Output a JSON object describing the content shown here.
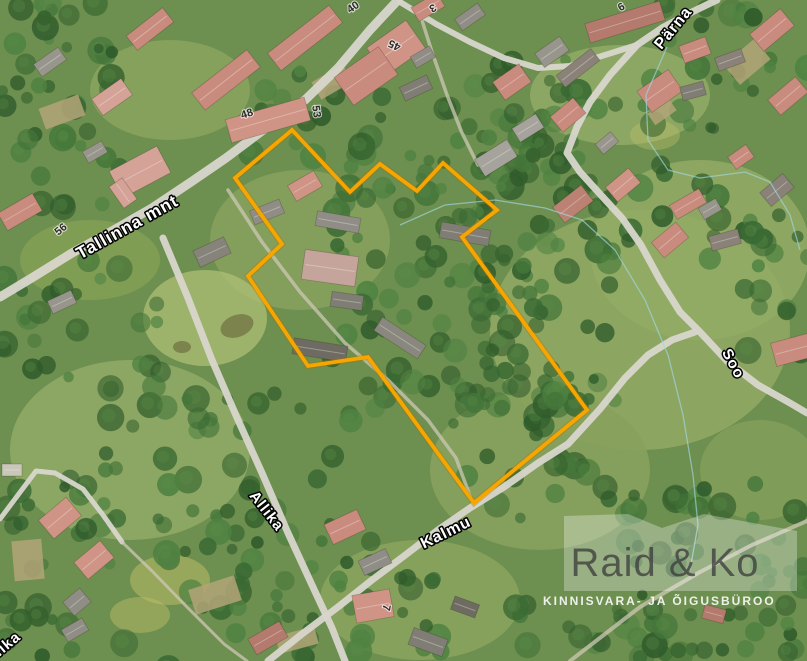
{
  "map": {
    "width": 807,
    "height": 661,
    "base_color": "#6d8f4f",
    "road_color": "#d8d6cc",
    "trail_color": "#cdc8b4",
    "boundary": {
      "color": "#F7A600",
      "glow_color": "#B36D00",
      "points": [
        [
          235,
          178
        ],
        [
          292,
          130
        ],
        [
          350,
          192
        ],
        [
          380,
          164
        ],
        [
          417,
          191
        ],
        [
          443,
          163
        ],
        [
          497,
          210
        ],
        [
          462,
          237
        ],
        [
          587,
          410
        ],
        [
          474,
          503
        ],
        [
          368,
          357
        ],
        [
          308,
          366
        ],
        [
          248,
          276
        ],
        [
          282,
          244
        ]
      ]
    },
    "cadastral_lines": {
      "color": "#9fd8e2",
      "lines": [
        [
          [
            400,
            225
          ],
          [
            445,
            205
          ],
          [
            495,
            200
          ],
          [
            545,
            208
          ],
          [
            582,
            220
          ],
          [
            615,
            250
          ],
          [
            645,
            300
          ],
          [
            668,
            355
          ],
          [
            683,
            415
          ],
          [
            693,
            475
          ],
          [
            698,
            525
          ],
          [
            690,
            570
          ]
        ],
        [
          [
            667,
            47
          ],
          [
            646,
            95
          ],
          [
            648,
            140
          ],
          [
            668,
            170
          ],
          [
            700,
            178
          ],
          [
            745,
            172
          ],
          [
            770,
            182
          ],
          [
            790,
            215
          ],
          [
            800,
            250
          ]
        ]
      ]
    },
    "roads": [
      {
        "name": "tallinna-mnt",
        "width": 9,
        "points": [
          [
            398,
            0
          ],
          [
            370,
            30
          ],
          [
            338,
            68
          ],
          [
            305,
            100
          ],
          [
            262,
            131
          ],
          [
            226,
            158
          ],
          [
            191,
            182
          ],
          [
            152,
            208
          ],
          [
            112,
            231
          ],
          [
            72,
            253
          ],
          [
            30,
            279
          ],
          [
            0,
            297
          ]
        ]
      },
      {
        "name": "parna-soo-road",
        "width": 7,
        "points": [
          [
            717,
            0
          ],
          [
            692,
            12
          ],
          [
            662,
            28
          ],
          [
            637,
            45
          ],
          [
            610,
            75
          ],
          [
            590,
            102
          ],
          [
            577,
            127
          ],
          [
            567,
            153
          ],
          [
            580,
            172
          ],
          [
            600,
            194
          ],
          [
            622,
            218
          ],
          [
            641,
            245
          ],
          [
            660,
            280
          ],
          [
            680,
            312
          ],
          [
            700,
            332
          ],
          [
            728,
            362
          ],
          [
            758,
            385
          ],
          [
            790,
            403
          ],
          [
            807,
            413
          ]
        ]
      },
      {
        "name": "north-link-road",
        "width": 6,
        "points": [
          [
            400,
            2
          ],
          [
            436,
            24
          ],
          [
            470,
            42
          ],
          [
            504,
            58
          ],
          [
            538,
            68
          ],
          [
            570,
            66
          ],
          [
            605,
            55
          ],
          [
            637,
            45
          ]
        ]
      },
      {
        "name": "allika-road",
        "width": 7,
        "points": [
          [
            163,
            238
          ],
          [
            188,
            298
          ],
          [
            212,
            360
          ],
          [
            238,
            420
          ],
          [
            262,
            473
          ],
          [
            288,
            533
          ],
          [
            312,
            585
          ],
          [
            332,
            628
          ],
          [
            345,
            661
          ]
        ]
      },
      {
        "name": "kalmu-road",
        "width": 7,
        "points": [
          [
            268,
            661
          ],
          [
            302,
            634
          ],
          [
            338,
            607
          ],
          [
            372,
            580
          ],
          [
            404,
            556
          ],
          [
            438,
            530
          ],
          [
            470,
            508
          ],
          [
            504,
            487
          ],
          [
            538,
            463
          ],
          [
            568,
            444
          ],
          [
            600,
            409
          ],
          [
            625,
            378
          ],
          [
            648,
            355
          ],
          [
            672,
            340
          ],
          [
            695,
            332
          ]
        ]
      },
      {
        "name": "west-lane",
        "width": 5,
        "points": [
          [
            0,
            519
          ],
          [
            36,
            471
          ],
          [
            55,
            473
          ],
          [
            83,
            489
          ],
          [
            103,
            515
          ],
          [
            122,
            542
          ]
        ]
      }
    ],
    "trails": [
      {
        "name": "west-trail",
        "width": 3,
        "points": [
          [
            122,
            542
          ],
          [
            152,
            571
          ],
          [
            186,
            606
          ],
          [
            224,
            644
          ],
          [
            247,
            661
          ]
        ]
      },
      {
        "name": "bottom-right-trail",
        "width": 4,
        "points": [
          [
            570,
            661
          ],
          [
            640,
            607
          ],
          [
            700,
            572
          ],
          [
            752,
            545
          ],
          [
            807,
            521
          ]
        ]
      },
      {
        "name": "north-driveway",
        "width": 3.5,
        "points": [
          [
            420,
            14
          ],
          [
            432,
            52
          ],
          [
            447,
            95
          ],
          [
            462,
            133
          ],
          [
            478,
            165
          ]
        ]
      },
      {
        "name": "farm-driveway",
        "width": 3.5,
        "points": [
          [
            228,
            190
          ],
          [
            262,
            242
          ],
          [
            300,
            292
          ],
          [
            345,
            343
          ],
          [
            388,
            380
          ],
          [
            428,
            420
          ],
          [
            456,
            458
          ],
          [
            470,
            496
          ]
        ]
      }
    ],
    "buildings": [
      [
        305,
        38,
        78,
        22,
        -38,
        "#c98b7d"
      ],
      [
        226,
        80,
        70,
        22,
        -38,
        "#c98b7d"
      ],
      [
        268,
        120,
        82,
        24,
        -16,
        "#cf9486"
      ],
      [
        150,
        29,
        46,
        18,
        -38,
        "#c98b7d"
      ],
      [
        112,
        97,
        36,
        20,
        -35,
        "#d4a296"
      ],
      [
        50,
        62,
        30,
        15,
        -35,
        "#98968c"
      ],
      [
        396,
        48,
        48,
        34,
        -35,
        "#cf9486"
      ],
      [
        366,
        76,
        54,
        34,
        -35,
        "#c98b7d"
      ],
      [
        423,
        57,
        22,
        13,
        -30,
        "#8f8d85"
      ],
      [
        416,
        88,
        30,
        15,
        -25,
        "#7f7d74"
      ],
      [
        428,
        7,
        30,
        16,
        -30,
        "#c98b7d"
      ],
      [
        470,
        17,
        28,
        14,
        -35,
        "#8f8d85"
      ],
      [
        496,
        158,
        38,
        20,
        -32,
        "#a5a39b"
      ],
      [
        528,
        128,
        28,
        16,
        -32,
        "#a5a39b"
      ],
      [
        512,
        82,
        32,
        22,
        -35,
        "#c98b7d"
      ],
      [
        552,
        52,
        30,
        17,
        -35,
        "#98968c"
      ],
      [
        625,
        22,
        78,
        20,
        -17,
        "#b57a6e"
      ],
      [
        578,
        68,
        44,
        15,
        -38,
        "#8a8178"
      ],
      [
        568,
        115,
        30,
        20,
        -40,
        "#c98b7d"
      ],
      [
        607,
        143,
        20,
        13,
        -40,
        "#98968c"
      ],
      [
        660,
        91,
        38,
        26,
        -35,
        "#c98b7d"
      ],
      [
        693,
        91,
        24,
        14,
        -15,
        "#7f7d74"
      ],
      [
        695,
        50,
        28,
        18,
        -20,
        "#c98b7d"
      ],
      [
        730,
        60,
        28,
        14,
        -20,
        "#8a8178"
      ],
      [
        772,
        30,
        40,
        22,
        -40,
        "#c98b7d"
      ],
      [
        788,
        96,
        36,
        20,
        -40,
        "#c98b7d"
      ],
      [
        741,
        157,
        22,
        15,
        -35,
        "#c98b7d"
      ],
      [
        623,
        185,
        30,
        19,
        -40,
        "#cf9486"
      ],
      [
        573,
        204,
        36,
        20,
        -38,
        "#bb8173"
      ],
      [
        688,
        204,
        34,
        16,
        -30,
        "#c98b7d"
      ],
      [
        710,
        209,
        20,
        13,
        -30,
        "#98968c"
      ],
      [
        670,
        240,
        32,
        20,
        -40,
        "#c98b7d"
      ],
      [
        725,
        240,
        30,
        15,
        -15,
        "#8a8178"
      ],
      [
        777,
        190,
        30,
        18,
        -40,
        "#8a8178"
      ],
      [
        792,
        350,
        38,
        24,
        -15,
        "#c98b7d"
      ],
      [
        305,
        186,
        30,
        18,
        -30,
        "#cf9486"
      ],
      [
        267,
        212,
        32,
        15,
        -22,
        "#8f8d85"
      ],
      [
        338,
        222,
        44,
        15,
        10,
        "#8f8d85"
      ],
      [
        330,
        268,
        54,
        30,
        8,
        "#c5a49c"
      ],
      [
        347,
        301,
        32,
        15,
        8,
        "#7f7d74"
      ],
      [
        320,
        350,
        54,
        16,
        9,
        "#6e6c62"
      ],
      [
        400,
        338,
        52,
        16,
        33,
        "#8a887e"
      ],
      [
        465,
        234,
        50,
        16,
        10,
        "#7f7d74"
      ],
      [
        212,
        252,
        34,
        18,
        -25,
        "#85837a"
      ],
      [
        140,
        172,
        54,
        30,
        -28,
        "#d4a296"
      ],
      [
        123,
        193,
        26,
        16,
        55,
        "#d4a296"
      ],
      [
        20,
        212,
        40,
        20,
        -30,
        "#c98b7d"
      ],
      [
        95,
        152,
        22,
        13,
        -30,
        "#98968c"
      ],
      [
        62,
        302,
        26,
        14,
        -25,
        "#98968c"
      ],
      [
        12,
        470,
        20,
        12,
        0,
        "#c9c6ba"
      ],
      [
        60,
        518,
        36,
        24,
        -40,
        "#cf9486"
      ],
      [
        94,
        560,
        34,
        22,
        -40,
        "#cf9486"
      ],
      [
        77,
        602,
        22,
        18,
        -40,
        "#8f8d85"
      ],
      [
        75,
        630,
        24,
        14,
        -30,
        "#8f8d85"
      ],
      [
        345,
        527,
        36,
        22,
        -25,
        "#c98b7d"
      ],
      [
        375,
        562,
        30,
        16,
        -25,
        "#8f8d85"
      ],
      [
        373,
        606,
        38,
        28,
        -10,
        "#cf9486"
      ],
      [
        428,
        642,
        36,
        18,
        20,
        "#7f7d74"
      ],
      [
        465,
        607,
        26,
        14,
        20,
        "#6e6c62"
      ],
      [
        268,
        638,
        36,
        18,
        -30,
        "#b57a6e"
      ],
      [
        714,
        614,
        22,
        14,
        15,
        "#b57a6e"
      ]
    ],
    "gardens": [
      [
        62,
        112,
        42,
        22,
        -20
      ],
      [
        332,
        82,
        36,
        20,
        -30
      ],
      [
        215,
        595,
        48,
        26,
        -18
      ],
      [
        297,
        640,
        40,
        18,
        -15
      ],
      [
        747,
        62,
        40,
        26,
        -40
      ],
      [
        28,
        560,
        30,
        40,
        -5
      ],
      [
        662,
        112,
        26,
        14,
        -35
      ]
    ],
    "ponds": [
      [
        237,
        326,
        17,
        11,
        -20
      ],
      [
        182,
        347,
        9,
        6,
        0
      ]
    ],
    "street_labels": [
      {
        "text": "Tallinna mnt",
        "x": 130,
        "y": 232,
        "rot": -29,
        "size": 17.5
      },
      {
        "text": "Pärna",
        "x": 677,
        "y": 31,
        "rot": -51,
        "size": 16
      },
      {
        "text": "Soo",
        "x": 729,
        "y": 366,
        "rot": 62,
        "size": 15
      },
      {
        "text": "Allika",
        "x": 263,
        "y": 514,
        "rot": 52,
        "size": 15
      },
      {
        "text": "Kalmu",
        "x": 448,
        "y": 537,
        "rot": -26,
        "size": 16
      },
      {
        "text": "Allika",
        "x": 4,
        "y": 653,
        "rot": -40,
        "size": 15
      }
    ],
    "house_numbers": [
      {
        "text": "40",
        "x": 355,
        "y": 10,
        "rot": -35
      },
      {
        "text": "3",
        "x": 431,
        "y": 5,
        "rot": 150
      },
      {
        "text": "45",
        "x": 396,
        "y": 42,
        "rot": 205
      },
      {
        "text": "6",
        "x": 623,
        "y": 10,
        "rot": -30
      },
      {
        "text": "48",
        "x": 248,
        "y": 117,
        "rot": -18
      },
      {
        "text": "53",
        "x": 313,
        "y": 112,
        "rot": 82
      },
      {
        "text": "56",
        "x": 63,
        "y": 232,
        "rot": -40
      },
      {
        "text": "7",
        "x": 383,
        "y": 607,
        "rot": 100
      }
    ]
  },
  "watermark": {
    "logo_text": "Raid & Ko",
    "tagline": "KINNISVARA- JA ÕIGUSBÜROO",
    "shape_opacity": 0.3,
    "shape_color": "#ffffff",
    "shape_points": [
      [
        564,
        591
      ],
      [
        564,
        516
      ],
      [
        628,
        514
      ],
      [
        662,
        528
      ],
      [
        704,
        514
      ],
      [
        797,
        531
      ],
      [
        797,
        591
      ]
    ]
  }
}
